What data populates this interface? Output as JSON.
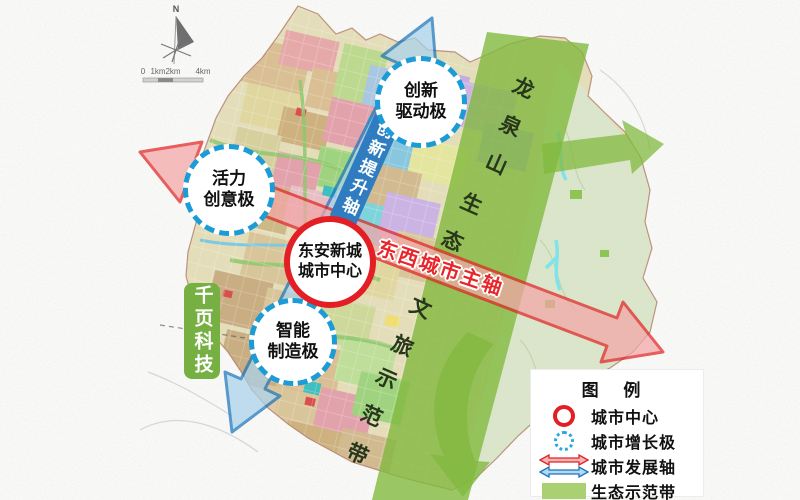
{
  "map": {
    "compass_north": "N",
    "scale_labels": [
      "0",
      "1km",
      "2km",
      "4km"
    ],
    "watermark": "千页科技",
    "city_center": {
      "lines": [
        "东安新城",
        "城市中心"
      ]
    },
    "growth_poles": [
      {
        "id": "innovation-drive",
        "lines": [
          "创新",
          "驱动极"
        ]
      },
      {
        "id": "vitality-creative",
        "lines": [
          "活力",
          "创意极"
        ]
      },
      {
        "id": "intelligent-manufacturing",
        "lines": [
          "智能",
          "制造极"
        ]
      }
    ],
    "axes": {
      "innovation_axis": "创新提升轴",
      "east_west_axis": "东西城市主轴"
    },
    "eco_belt": {
      "label": "龙泉山生态文旅示范带",
      "chars": [
        "龙",
        "泉",
        "山",
        "生",
        "态",
        "文",
        "旅",
        "示",
        "范",
        "带"
      ]
    }
  },
  "legend": {
    "title": "图 例",
    "items": [
      {
        "symbol": "red-circle",
        "label": "城市中心"
      },
      {
        "symbol": "dashed-circle",
        "label": "城市增长极"
      },
      {
        "symbol": "double-arrows",
        "label": "城市发展轴"
      },
      {
        "symbol": "green-band",
        "label": "生态示范带"
      }
    ]
  },
  "colors": {
    "city_center_red": "#e31e24",
    "growth_pole_blue": "#1b9cd7",
    "development_axis_red": "#e02424",
    "development_axis_blue": "#1b75bb",
    "eco_belt_green": "#82b93f",
    "legend_swatch_green": "#a9d171",
    "watermark_green": "#76b043"
  }
}
